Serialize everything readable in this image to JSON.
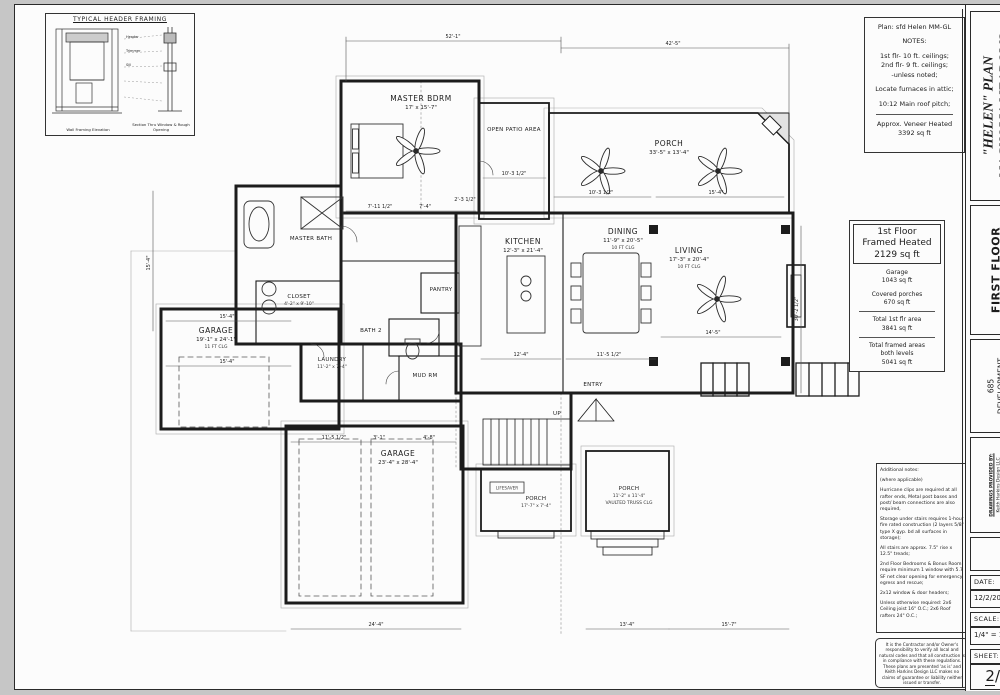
{
  "sheet": {
    "detail_box": {
      "title": "TYPICAL HEADER FRAMING",
      "caption_left": "Wall Framing Elevation",
      "caption_right": "Section Thru Window & Rough Opening"
    },
    "notes_box": {
      "plan_line": "Plan: sfd Helen MM-GL",
      "notes_title": "NOTES:",
      "line1": "1st flr- 10 ft. ceilings;",
      "line2": "2nd flr- 9 ft. ceilings;",
      "line3": "-unless noted;",
      "line4": "Locate furnaces in attic;",
      "line5": "10:12 Main roof pitch;",
      "veneer1": "Approx. Veneer Heated",
      "veneer2": "3392 sq ft"
    },
    "area_box": {
      "headline1": "1st Floor",
      "headline2": "Framed Heated",
      "headline3": "2129 sq ft",
      "garage_label": "Garage",
      "garage_value": "1043 sq ft",
      "porches_label": "Covered porches",
      "porches_value": "670 sq ft",
      "total1_label": "Total 1st flr area",
      "total1_value": "3841 sq ft",
      "total2_label1": "Total framed areas",
      "total2_label2": "both levels",
      "total2_value": "5041 sq ft"
    },
    "additional_notes": {
      "title1": "Additional notes:",
      "title2": "(where applicable)",
      "p1": "Hurricane clips are required at all rafter ends, Metal post bases and post/ beam connections are also required,",
      "p2": "Storage under stairs requires 1-hour fire rated construction (2 layers 5/8\" type X gyp. bd all surfaces in storage);",
      "p3": "All stairs are approx. 7.5\" rise x 12.5\" treads;",
      "p4": "2nd Floor Bedrooms & Bonus Room require minimum 1 window with 5.7 SF net clear opening for emergency egress and rescue;",
      "p5": "2x12 window & door headers;",
      "p6": "Unless otherwise required: 2x6 Ceiling joist 16\" O.C.; 2x6 Roof rafters 24\" O.C.;"
    },
    "disclaimer": "It is the Contractor and/or Owner's responsibility to verify all local and natural codes and that all construction is in compliance with these regulations. These plans are presented 'as is' and Keith Harkins Design LLC makes no claims of guarantee or liability neither issued or transfer.",
    "titleblock": {
      "plan_title1": "\"HELEN\" PLAN",
      "plan_title2": "MAGNOLIA MEADOWS",
      "floor": "FIRST FLOOR",
      "client1": "685",
      "client2": "DEVELOPMENT",
      "provided_by1": "DRAWINGS PROVIDED BY:",
      "provided_by2": "Keith Harkins Design LLC",
      "date_label": "DATE:",
      "date_value": "12/2/202",
      "scale_label": "SCALE:",
      "scale_value": "1/4\" = 1",
      "sheet_label": "SHEET:",
      "sheet_value_top": "2",
      "sheet_value_rest": "/4"
    }
  },
  "plan": {
    "rooms": [
      {
        "label": "MASTER BDRM",
        "dim": "17' x 15'-7\""
      },
      {
        "label": "PORCH",
        "dim": "33'-5\" x 13'-4\""
      },
      {
        "label": "OPEN PATIO AREA"
      },
      {
        "label": "KITCHEN",
        "dim": "12'-3\" x 21'-4\""
      },
      {
        "label": "DINING",
        "dim": "11'-9\" x 20'-5\"",
        "sub": "10 FT CLG"
      },
      {
        "label": "LIVING",
        "dim": "17'-3\" x 20'-4\"",
        "sub": "10 FT CLG"
      },
      {
        "label": "GARAGE",
        "dim": "19'-1\" x 24'-1\"",
        "sub": "11 FT CLG"
      },
      {
        "label": "GARAGE",
        "dim": "23'-4\" x 28'-4\""
      },
      {
        "label": "MASTER BATH"
      },
      {
        "label": "CLOSET",
        "dim": "4'-2\" x 9'-10\""
      },
      {
        "label": "LAUNDRY",
        "dim": "11'-2\" x 7'-4\""
      },
      {
        "label": "MUD RM"
      },
      {
        "label": "PANTRY"
      },
      {
        "label": "BATH 2"
      },
      {
        "label": "ENTRY"
      },
      {
        "label": "PORCH",
        "dim": "17'-7\" x 7'-4\""
      },
      {
        "label": "PORCH",
        "dim": "11'-2\" x 11'-4\"",
        "sub": "VAULTED TRUSS CLG"
      },
      {
        "label": "UP"
      },
      {
        "label": "LIFESAVER"
      }
    ],
    "dims": [
      "52'-1\"",
      "42'-5\"",
      "15'-4\"",
      "30'-2 1/2\"",
      "24'-4\"",
      "13'-4\"",
      "15'-7\"",
      "12'-4\"",
      "11'-5 1/2\"",
      "14'-5\"",
      "15'-4\"",
      "15'-4\"",
      "11'-5 1/2\"",
      "3'-1\"",
      "4'-8\"",
      "10'-3 1/2\"",
      "15'-4\"",
      "7'-11 1/2\"",
      "7'-4\"",
      "2'-3 1/2\"",
      "10'-3 1/2\""
    ]
  }
}
